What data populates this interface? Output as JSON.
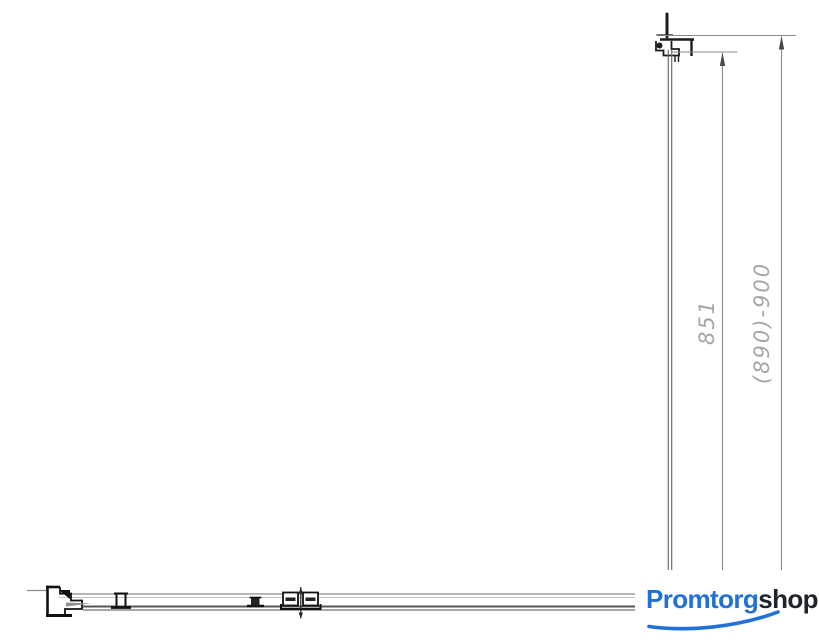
{
  "page": {
    "background": "#ffffff",
    "description": "Technical dimension drawing of a shower enclosure glass panel profile (side elevation and top plan view)"
  },
  "drawing": {
    "dimensions": {
      "glass_height": {
        "label": "851"
      },
      "total_height": {
        "label": "(890)-900"
      }
    },
    "colors": {
      "dim_text": "#a6a6a6",
      "line_gray": "#8a8a8a",
      "line_dark": "#1c1c1c"
    }
  },
  "logo": {
    "part1": "Promtorg",
    "part2": "shop",
    "color_primary": "#2271d8",
    "color_secondary": "#21252b"
  }
}
